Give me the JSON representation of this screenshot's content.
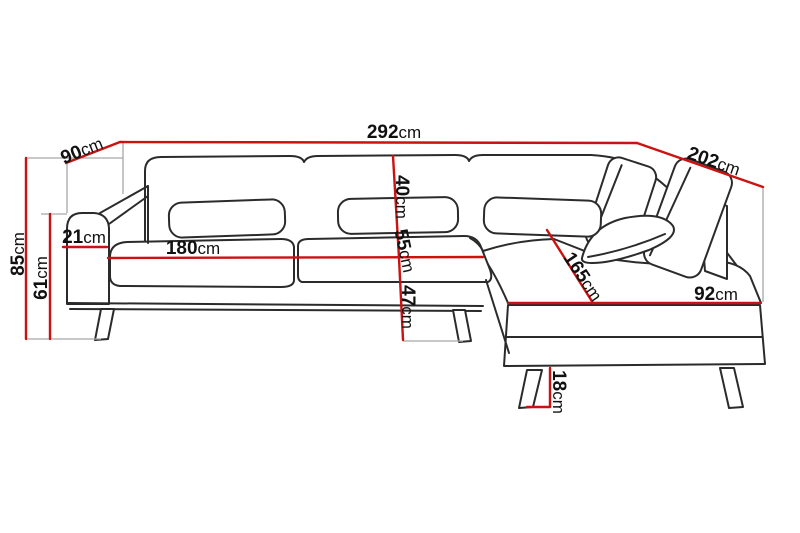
{
  "diagram": {
    "unit": "cm",
    "colors": {
      "dimension_line": "#cc1111",
      "outline": "#2b2b2b",
      "extension_line": "#a8a8a8",
      "background": "#ffffff",
      "label_text": "#111111"
    },
    "dimensions": [
      {
        "id": "total-width",
        "value": "292",
        "unit": "cm"
      },
      {
        "id": "back-section-depth",
        "value": "90",
        "unit": "cm"
      },
      {
        "id": "chaise-section-depth",
        "value": "202",
        "unit": "cm"
      },
      {
        "id": "back-height",
        "value": "85",
        "unit": "cm"
      },
      {
        "id": "armrest-height",
        "value": "61",
        "unit": "cm"
      },
      {
        "id": "armrest-width",
        "value": "21",
        "unit": "cm"
      },
      {
        "id": "seat-width",
        "value": "180",
        "unit": "cm"
      },
      {
        "id": "backrest-height",
        "value": "40",
        "unit": "cm"
      },
      {
        "id": "seat-depth",
        "value": "55",
        "unit": "cm"
      },
      {
        "id": "seat-height",
        "value": "47",
        "unit": "cm"
      },
      {
        "id": "chaise-length",
        "value": "165",
        "unit": "cm"
      },
      {
        "id": "chaise-width",
        "value": "92",
        "unit": "cm"
      },
      {
        "id": "leg-height",
        "value": "18",
        "unit": "cm"
      }
    ]
  }
}
